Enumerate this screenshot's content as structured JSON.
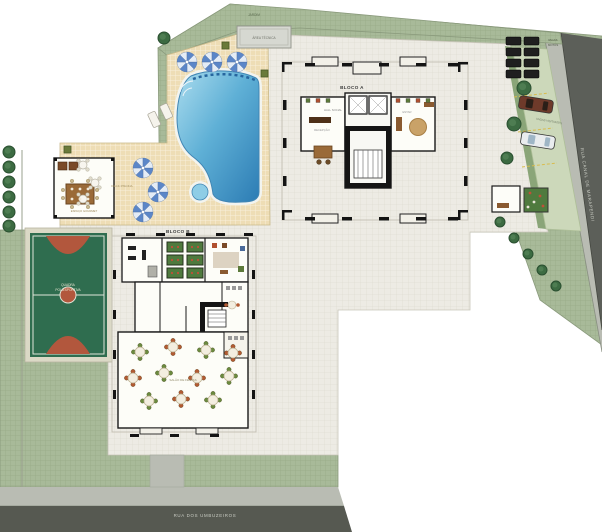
{
  "plan": {
    "type": "Planta de implantação (site plan)",
    "labels": {
      "bloco_a": "BLOCO A",
      "bloco_b": "BLOCO B",
      "street_bottom": "RUA DOS UMBUZEIROS",
      "street_right": "RUA CANAL DE MARAPENDI",
      "deck": "DECK PISCINA",
      "court_l1": "QUADRA",
      "court_l2": "POLIESPORTIVA",
      "party_hall": "SALÃO DE FESTAS",
      "hall_a": "HALL SOCIAL",
      "reception": "RECEPÇÃO",
      "estar": "ESTAR",
      "parking": "VAGAS VISITANTES",
      "motos_l1": "VAGAS",
      "motos_l2": "MOTOS",
      "garden": "JARDIM",
      "tech": "ÁREA TÉCNICA",
      "gourmet": "ESPAÇO GOURMET"
    },
    "colors": {
      "grass": "#a8ba99",
      "slab": "#edebe4",
      "deck": "#eeddb5",
      "road": "#5c5f59",
      "sidewalk": "#b9bcb3",
      "pool_deep": "#2c7cb4",
      "pool_shallow": "#aadcee",
      "court_green": "#2f6d4f",
      "court_clay": "#b2573d",
      "walls": "#1a1a1a",
      "umbrella_blue": "#5b86c8"
    }
  }
}
